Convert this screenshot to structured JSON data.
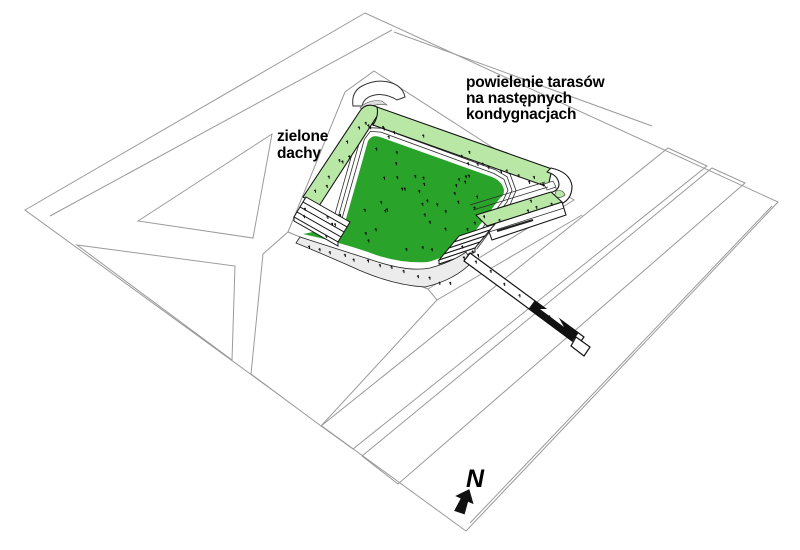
{
  "diagram": {
    "kind": "architectural-axonometric-site-diagram",
    "labels": {
      "green_roofs": {
        "line1": "zielone",
        "line2": "dachy"
      },
      "terraces": {
        "line1": "powielenie tarasów",
        "line2": "na następnych",
        "line3": "kondygnacjach"
      }
    },
    "north_indicator": {
      "label": "N"
    },
    "colors": {
      "green_roof": "#b9e8a6",
      "courtyard_green": "#2aa32a",
      "road_gray": "#e6e6e6",
      "site_line_gray": "#9a9a9a",
      "building_line": "#141414",
      "plinth_gray": "#ececec"
    }
  }
}
